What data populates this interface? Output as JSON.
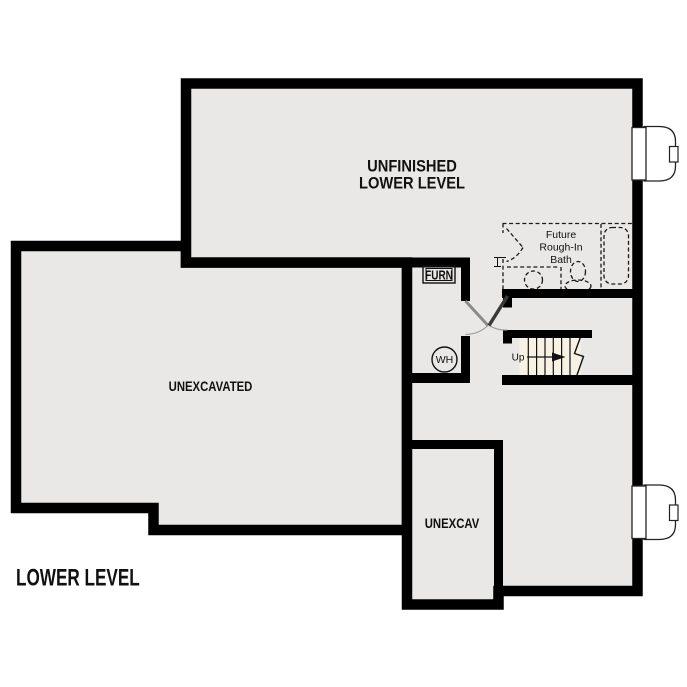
{
  "plan_title": "LOWER LEVEL",
  "rooms": {
    "unfinished_line1": "UNFINISHED",
    "unfinished_line2": "LOWER LEVEL",
    "unexcavated": "UNEXCAVATED",
    "unexcav": "UNEXCAV"
  },
  "equipment": {
    "furnace": "FURN",
    "water_heater": "WH"
  },
  "bath": {
    "line1": "Future",
    "line2": "Rough-In",
    "line3": "Bath"
  },
  "stairs": {
    "up": "Up"
  },
  "colors": {
    "background": "#ffffff",
    "wall": "#000000",
    "floor": "#e9e8e6",
    "stair_tread": "#f8f2e4"
  }
}
